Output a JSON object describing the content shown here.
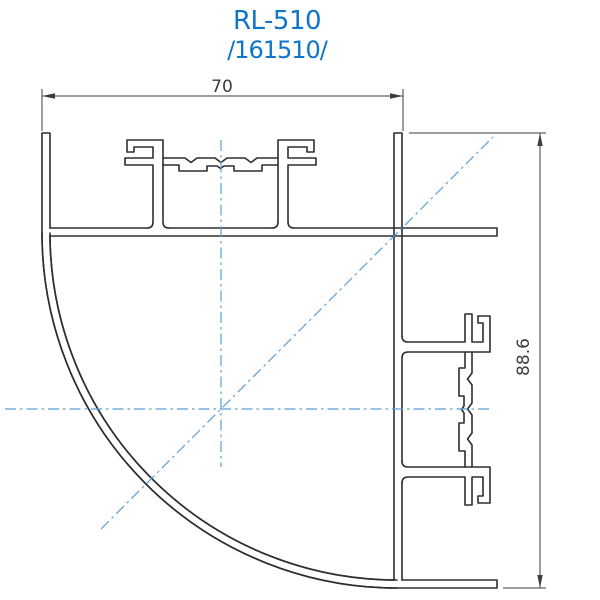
{
  "title": {
    "model": "RL-510",
    "part_number": "/161510/"
  },
  "dimensions": {
    "width": "70",
    "height": "88.6"
  },
  "colors": {
    "title_blue": "#0f75c8",
    "centerline_blue": "#5b9fd8",
    "outline_dark": "#2e2e2e",
    "dimension_dark": "#3c3c3c"
  }
}
